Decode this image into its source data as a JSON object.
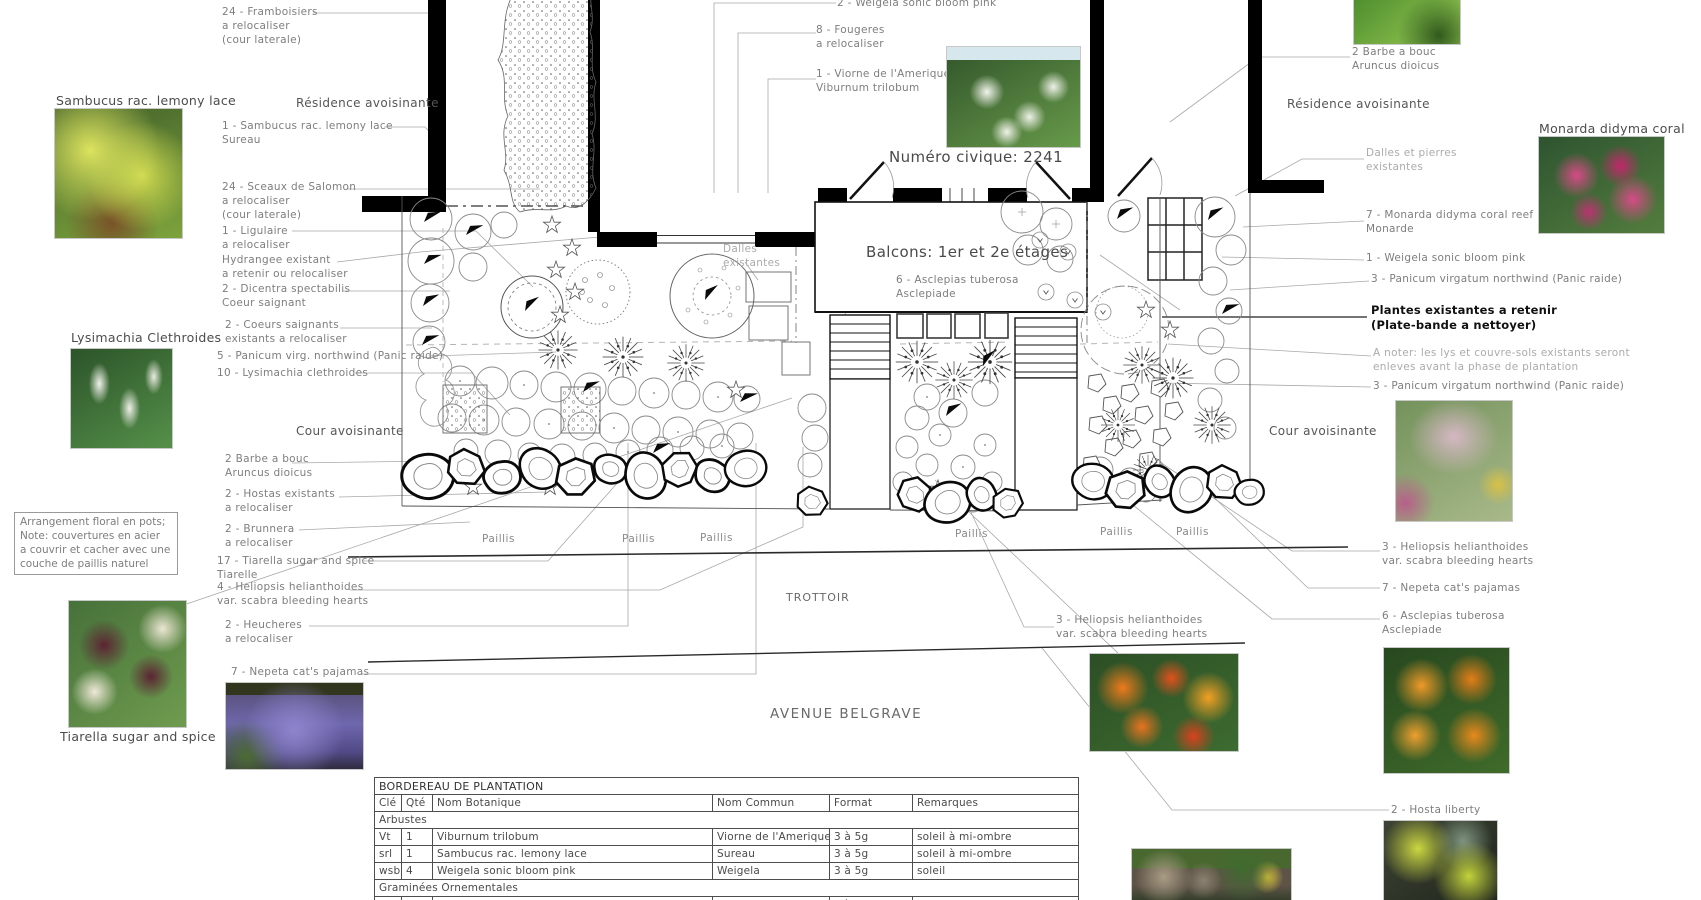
{
  "colors": {
    "background": "#ffffff",
    "wall_black": "#000000",
    "leader_gray": "#a8a8a8",
    "callout_text": "#7e7e7e",
    "heading_text": "#4f4f4f",
    "light_text": "#ababab",
    "emphasis_text": "#111111"
  },
  "plan": {
    "civic": "Numéro civique: 2241",
    "balconies": "Balcons: 1er et 2e étages",
    "trottoir": "TROTTOIR",
    "avenue": "AVENUE BELGRAVE",
    "paillis": "Paillis"
  },
  "headings": {
    "residence": "Résidence avoisinante",
    "cour": "Cour avoisinante"
  },
  "note": "Arrangement floral en pots;\nNote: couvertures en acier\na couvrir et cacher avec une\ncouche de paillis naturel",
  "callouts": {
    "framboisiers": "24 - Framboisiers\na relocaliser\n(cour laterale)",
    "sambucus": "1 - Sambucus rac. lemony lace\nSureau",
    "sceaux": "24 - Sceaux de Salomon\na relocaliser\n(cour laterale)",
    "ligulaire": "1 - Ligulaire\na relocaliser",
    "hydrangee": "Hydrangee existant\na retenir ou relocaliser",
    "dicentra": "2 - Dicentra spectabilis\nCoeur saignant",
    "coeurs": "2 - Coeurs saignants\nexistants a relocaliser",
    "panicum5": "5 - Panicum virg. northwind (Panic raide)",
    "lysimachia10": "10 - Lysimachia clethroides",
    "barbe": "2 Barbe a bouc\nAruncus dioicus",
    "hostas": "2 - Hostas existants\na relocaliser",
    "brunnera": "2 - Brunnera\na relocaliser",
    "tiarella17": "17 - Tiarella sugar and spice\nTiarelle",
    "heliopsis4": "4 - Heliopsis helianthoides\nvar. scabra bleeding hearts",
    "heucheres": "2 - Heucheres\na relocaliser",
    "nepeta7": "7 - Nepeta cat's pajamas",
    "weigela2": "2 - Weigela sonic bloom pink",
    "fougeres": "8 - Fougeres\na relocaliser",
    "viorne": "1 - Viorne de l'Amerique\nViburnum trilobum",
    "asclepias6": "6 - Asclepias tuberosa\nAsclepiade",
    "dalles_existantes": "Dalles\nexistantes",
    "dalles_pierres": "Dalles et pierres\nexistantes",
    "monarda7": "7 - Monarda didyma coral reef\nMonarde",
    "weigela1": "1 - Weigela sonic bloom pink",
    "panicum3": "3 - Panicum virgatum northwind (Panic raide)",
    "plantes_existantes": "Plantes existantes a retenir\n(Plate-bande a nettoyer)",
    "a_noter": "A noter: les lys et couvre-sols existants seront\nenleves avant la phase de plantation",
    "heliopsis3": "3 - Heliopsis helianthoides\nvar. scabra bleeding hearts",
    "hosta2": "2 - Hosta liberty"
  },
  "photo_labels": {
    "sambucus": "Sambucus rac. lemony lace",
    "lysimachia": "Lysimachia Clethroides",
    "tiarella": "Tiarella sugar and spice",
    "monarda": "Monarda didyma coral reef"
  },
  "table": {
    "title": "BORDEREAU DE PLANTATION",
    "columns": [
      "Clé",
      "Qté",
      "Nom Botanique",
      "Nom Commun",
      "Format",
      "Remarques"
    ],
    "sections": [
      {
        "name": "Arbustes",
        "rows": [
          [
            "Vt",
            "1",
            "Viburnum trilobum",
            "Viorne de l'Amerique",
            "3 à 5g",
            "soleil à mi-ombre"
          ],
          [
            "srl",
            "1",
            "Sambucus rac. lemony lace",
            "Sureau",
            "3 à 5g",
            "soleil à mi-ombre"
          ],
          [
            "wsb",
            "4",
            "Weigela sonic bloom pink",
            "Weigela",
            "3 à 5g",
            "soleil"
          ]
        ]
      },
      {
        "name": "Graminées Ornementales",
        "rows": [
          [
            "pvn",
            "11",
            "Panicum virgatum northwind",
            "Panic raide",
            "1 à 2g",
            "soleil"
          ]
        ]
      }
    ]
  }
}
